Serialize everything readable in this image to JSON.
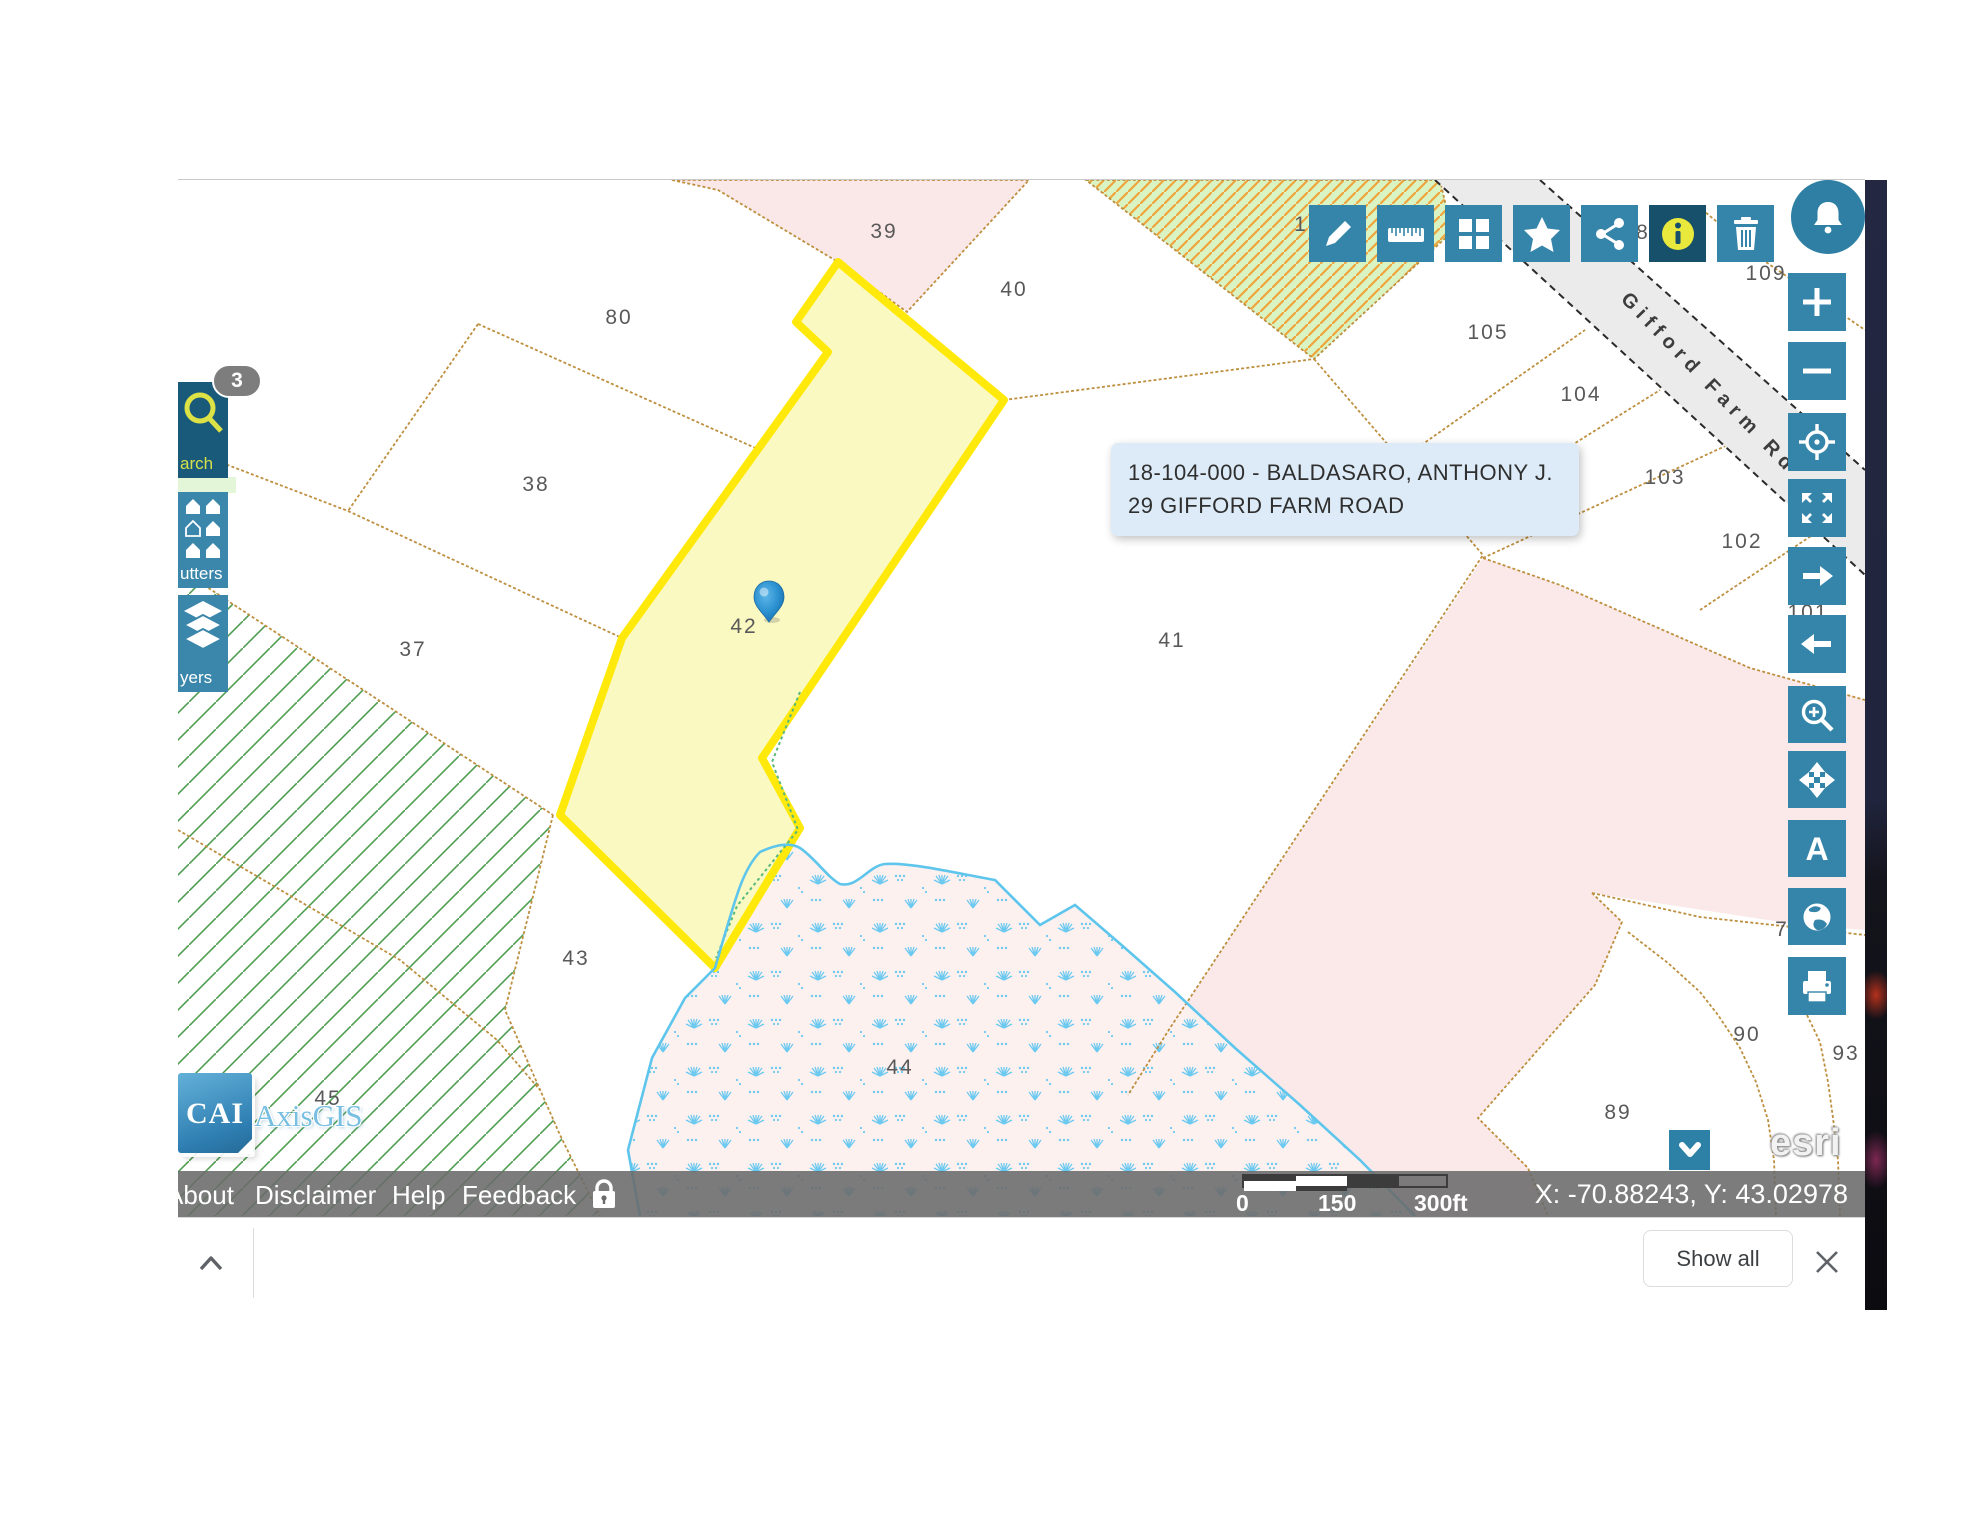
{
  "header_toolbar": {
    "buttons": [
      {
        "id": "draw",
        "icon": "pencil-icon"
      },
      {
        "id": "measure",
        "icon": "ruler-icon"
      },
      {
        "id": "basemap",
        "icon": "grid-icon"
      },
      {
        "id": "bookmarks",
        "icon": "star-icon"
      },
      {
        "id": "share",
        "icon": "share-icon"
      },
      {
        "id": "identify",
        "icon": "info-icon",
        "active": true
      },
      {
        "id": "clear-selection",
        "icon": "trash-icon"
      }
    ],
    "notifications_icon": "bell-icon"
  },
  "left_panel": {
    "badge_count": "3",
    "items": [
      {
        "id": "search",
        "visible_label": "arch",
        "icon": "search-icon"
      },
      {
        "id": "abutters",
        "visible_label": "utters",
        "icon": "abutters-houses-icon"
      },
      {
        "id": "layers",
        "visible_label": "yers",
        "icon": "layers-icon"
      }
    ]
  },
  "map_tools": {
    "road_a_glyph": "A",
    "buttons": [
      {
        "id": "zoom-in",
        "icon": "plus-icon"
      },
      {
        "id": "zoom-out",
        "icon": "minus-icon"
      },
      {
        "id": "default-extent",
        "icon": "target-icon"
      },
      {
        "id": "full-extent",
        "icon": "fullscreen-icon"
      },
      {
        "id": "next-extent",
        "icon": "arrow-right-icon"
      },
      {
        "id": "previous-extent",
        "icon": "arrow-left-icon"
      },
      {
        "id": "zoom-window",
        "icon": "magnifier-plus-icon"
      },
      {
        "id": "pan",
        "icon": "move-icon"
      },
      {
        "id": "streets",
        "icon": "road-a-icon"
      },
      {
        "id": "overview",
        "icon": "globe-icon"
      },
      {
        "id": "print",
        "icon": "printer-icon"
      }
    ],
    "collapse_icon": "chevron-down-icon"
  },
  "tooltip": {
    "line1": "18-104-000 - BALDASARO, ANTHONY J.",
    "line2": "29 GIFFORD FARM ROAD"
  },
  "map": {
    "road_label": "Gifford Farm Rd",
    "parcel_labels": [
      {
        "text": "39"
      },
      {
        "text": "40"
      },
      {
        "text": "80"
      },
      {
        "text": "38"
      },
      {
        "text": "37"
      },
      {
        "text": "42"
      },
      {
        "text": "41"
      },
      {
        "text": "43"
      },
      {
        "text": "44"
      },
      {
        "text": "45"
      },
      {
        "text": "105"
      },
      {
        "text": "104"
      },
      {
        "text": "103"
      },
      {
        "text": "102"
      },
      {
        "text": "109"
      },
      {
        "text": "90"
      },
      {
        "text": "93"
      },
      {
        "text": "89"
      },
      {
        "text": "101"
      },
      {
        "text": "8"
      },
      {
        "text": "7"
      },
      {
        "text": "1"
      }
    ]
  },
  "status_bar": {
    "links": [
      "About",
      "Disclaimer",
      "Help",
      "Feedback"
    ],
    "lock_icon": "lock-icon",
    "scale": {
      "zero": "0",
      "mid": "150",
      "max": "300ft"
    },
    "coordinates": "X: -70.88243, Y: 43.02978"
  },
  "logos": {
    "cai": "CAI",
    "axisgis": "AxisGIS",
    "esri": "esri"
  },
  "download_bar": {
    "show_all_label": "Show all"
  },
  "colors": {
    "accent_teal": "#3585aa",
    "accent_teal_dark": "#17506b",
    "highlight_stroke": "#ffe90a",
    "highlight_fill": "#fbf9c2",
    "pin_blue": "#2a90cf",
    "tooltip_bg": "#dcebf7",
    "parcel_line": "#bd8f3e",
    "wetland_blue": "#5ec5ec",
    "hatch_green": "#4f9d50"
  }
}
